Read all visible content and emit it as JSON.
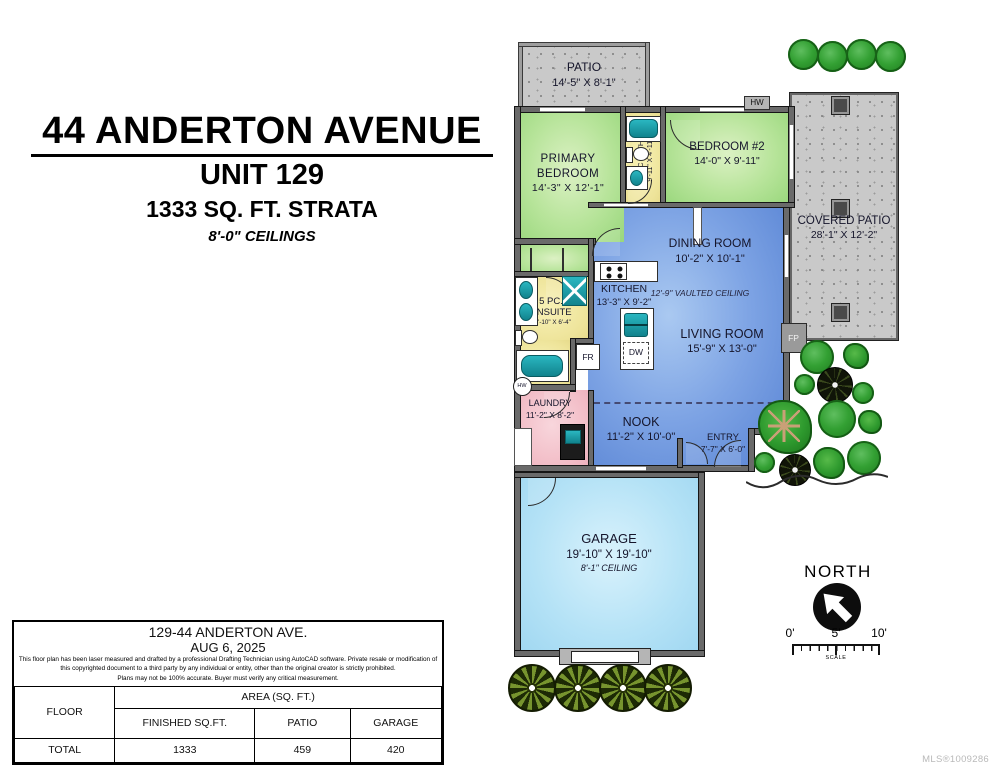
{
  "header": {
    "address": "44 ANDERTON AVENUE",
    "unit": "UNIT 129",
    "area": "1333 SQ. FT. STRATA",
    "ceilings": "8'-0\" CEILINGS"
  },
  "rooms": {
    "patio": {
      "name": "PATIO",
      "dims": "14'-5\" X 8'-1\""
    },
    "primary_bedroom": {
      "line1": "PRIMARY",
      "line2": "BEDROOM",
      "dims": "14'-3\" X 12'-1\""
    },
    "bath": {
      "name": "4 PC BATH",
      "dims": "9'-11\" X 4'-11\""
    },
    "bedroom2": {
      "name": "BEDROOM #2",
      "dims": "14'-0\" X 9'-11\""
    },
    "covered_patio": {
      "name": "COVERED PATIO",
      "dims": "28'-1\" X 12'-2\""
    },
    "dining": {
      "name": "DINING ROOM",
      "dims": "10'-2\" X 10'-1\""
    },
    "kitchen": {
      "name": "KITCHEN",
      "dims": "13'-3\" X 9'-2\""
    },
    "living": {
      "name": "LIVING ROOM",
      "dims": "15'-9\" X 13'-0\""
    },
    "vaulted_note": "12'-9\" VAULTED CEILING",
    "ensuite": {
      "line1": "5 PC.",
      "line2": "ENSUITE",
      "dims": "10'-10\" X 6'-4\""
    },
    "laundry": {
      "name": "LAUNDRY",
      "dims": "11'-2\" X 8'-2\""
    },
    "nook": {
      "name": "NOOK",
      "dims": "11'-2\" X 10'-0\""
    },
    "entry": {
      "name": "ENTRY",
      "dims": "7'-7\" X 6'-0\""
    },
    "garage": {
      "name": "GARAGE",
      "dims": "19'-10\" X 19'-10\"",
      "ceiling": "8'-1\" CEILING"
    }
  },
  "tags": {
    "hw_upper": "HW",
    "hw_tank": "HW",
    "fp": "FP",
    "fr": "FR",
    "dw": "DW",
    "built_in": "BUILT-IN"
  },
  "compass": {
    "label": "NORTH"
  },
  "scale_bar": {
    "t0": "0'",
    "t5": "5'",
    "t10": "10'",
    "label": "SCALE"
  },
  "info_table": {
    "title": "129-44 ANDERTON AVE.",
    "date": "AUG 6, 2025",
    "disclaimer": [
      "This floor plan has been laser measured and drafted by a professional Drafting Technician using AutoCAD software. Private resale or modification of",
      "this copyrighted document to a third party by any individual or entity, other than the original creator is strictly prohibited.",
      "Plans may not be 100% accurate.  Buyer must verify any critical measurement."
    ],
    "floor_col": "FLOOR",
    "area_group": "AREA (SQ. FT.)",
    "columns": [
      "FINISHED SQ.FT.",
      "PATIO",
      "GARAGE"
    ],
    "total_row": {
      "label": "TOTAL",
      "finished": "1333",
      "patio": "459",
      "garage": "420"
    }
  },
  "watermark": "MLS®1009286",
  "colors": {
    "wall": "#6a6a6a",
    "bedroom_green": "#b7e49a",
    "living_blue": "#7da3e4",
    "garage_cyan": "#b4e2f6",
    "bath_yellow": "#eee49a",
    "laundry_pink": "#f2bcc6",
    "fixture_teal": "#17a2ac",
    "patio_gray": "#c9c9c9"
  }
}
